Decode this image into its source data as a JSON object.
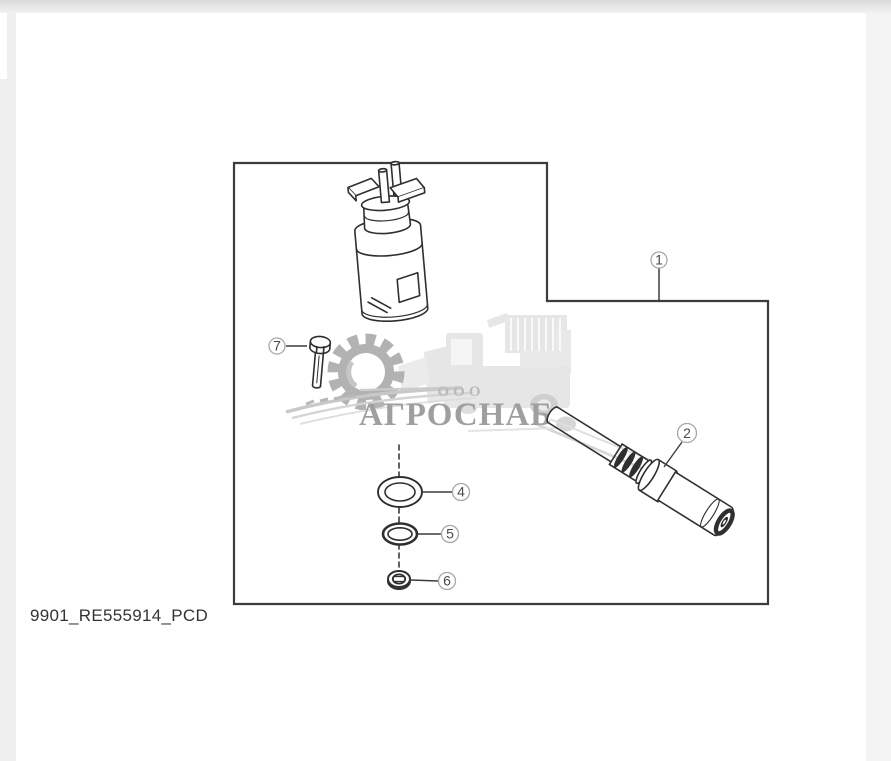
{
  "page": {
    "caption": "9901_RE555914_PCD"
  },
  "watermark": {
    "org_form": "ООО",
    "org_name": "АГРОСНАБ"
  },
  "diagram": {
    "callouts": {
      "c1": "1",
      "c2": "2",
      "c4": "4",
      "c5": "5",
      "c6": "6",
      "c7": "7"
    }
  },
  "colors": {
    "line": "#2f2f2f",
    "outline": "#3c3c3c",
    "callout_ring": "#a8a8a8",
    "callout_number": "#4a4a4a",
    "watermark_gray": "#b2b2b2",
    "watermark_light": "#e6e6e6",
    "watermark_text": "#9f9f9f",
    "watermark_ooo": "#b9b9b9"
  }
}
